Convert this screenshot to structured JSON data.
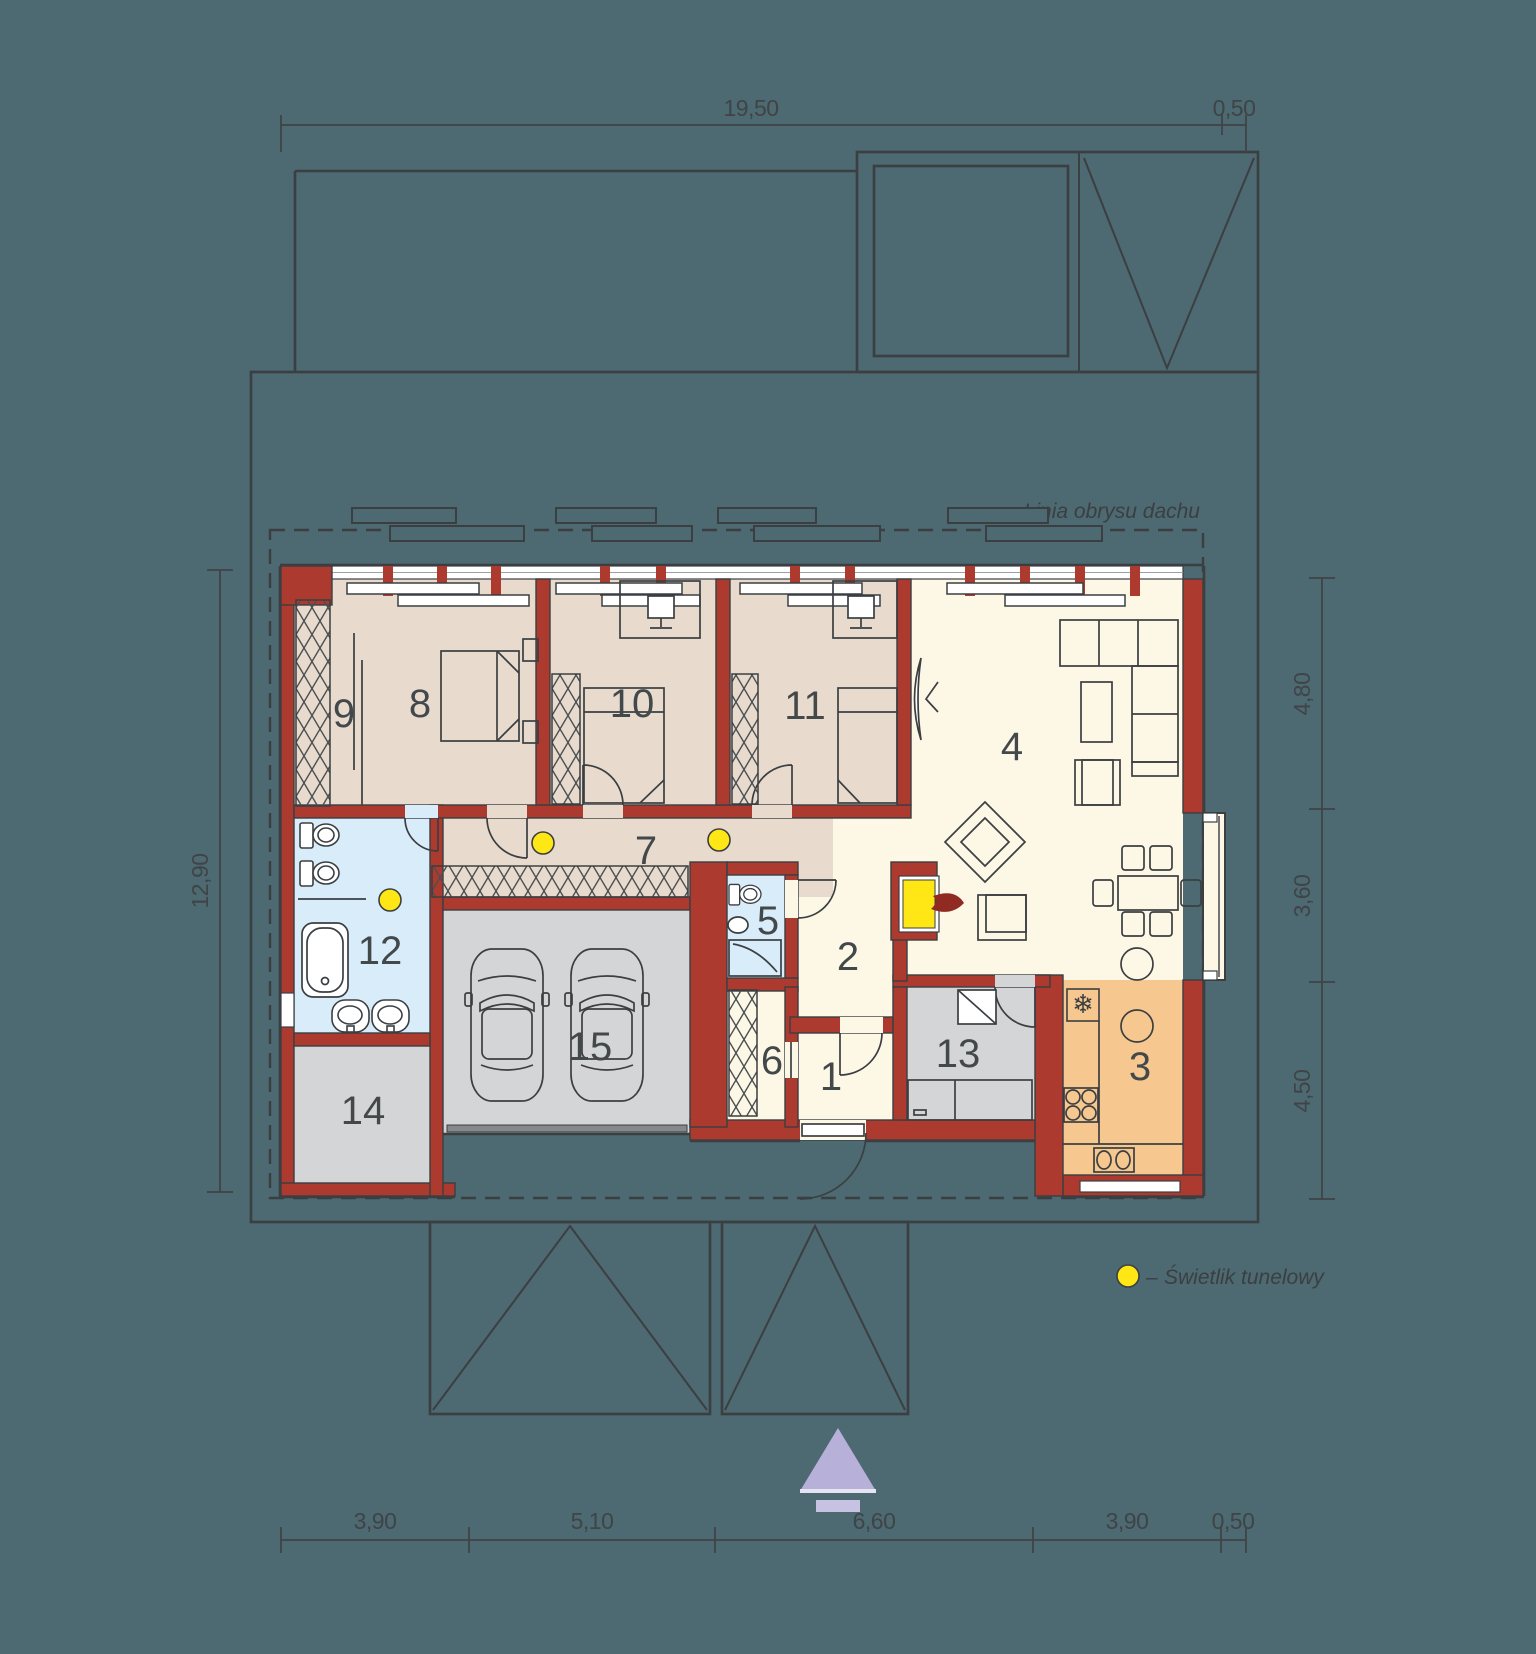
{
  "dimensions": {
    "top": [
      "19,50",
      "0,50"
    ],
    "bottom": [
      "3,90",
      "5,10",
      "6,60",
      "3,90",
      "0,50"
    ],
    "left": [
      "12,90"
    ],
    "right": [
      "4,80",
      "3,60",
      "4,50"
    ]
  },
  "rooms": [
    {
      "label": "1"
    },
    {
      "label": "2"
    },
    {
      "label": "3"
    },
    {
      "label": "4"
    },
    {
      "label": "5"
    },
    {
      "label": "6"
    },
    {
      "label": "7"
    },
    {
      "label": "8"
    },
    {
      "label": "9"
    },
    {
      "label": "10"
    },
    {
      "label": "11"
    },
    {
      "label": "12"
    },
    {
      "label": "13"
    },
    {
      "label": "14"
    },
    {
      "label": "15"
    }
  ],
  "annotations": {
    "roof_outline": "Linia obrysu dachu"
  },
  "legend": {
    "separator": "–",
    "skylight_label": "Świetlik tunelowy"
  },
  "icons": {
    "freezer_snowflake": "❄"
  },
  "colors": {
    "background": "#4d6971",
    "wall": "#ad3a2f",
    "line": "#3b3f42",
    "floor-bedroom": "#e8dacd",
    "floor-living": "#fdf7e6",
    "floor-bath": "#d9ecfa",
    "floor-garage": "#d4d5d6",
    "floor-kitchen": "#f6c78f",
    "skylight": "#ffe715",
    "arrow": "#b7b0d8",
    "label": "#43484b"
  }
}
